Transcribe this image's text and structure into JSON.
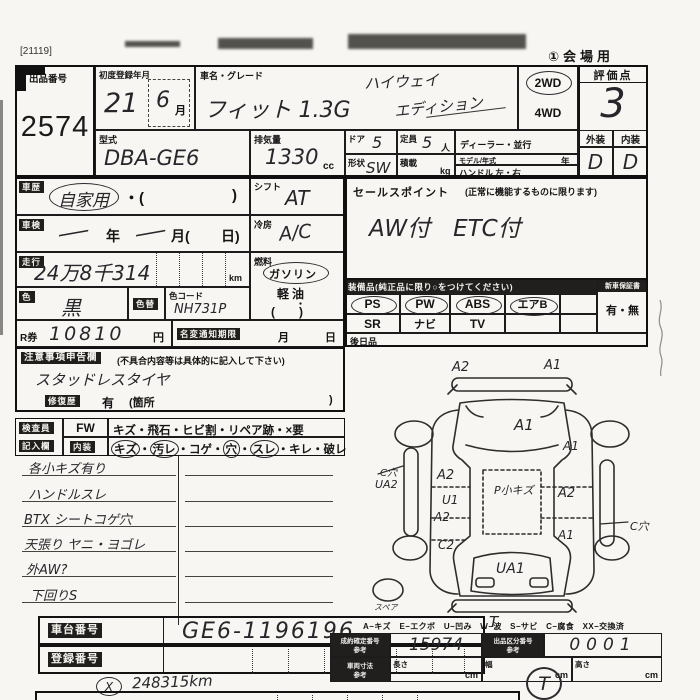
{
  "page": {
    "corner_code": "[21119]",
    "venue": "①会場用"
  },
  "header": {
    "auction_no_label": "出品番号",
    "auction_no": "2574",
    "first_reg_label": "初度登録年月",
    "first_reg_year": "21",
    "first_reg_month": "6",
    "month_suffix": "月",
    "car_name_label": "車名・グレード",
    "car_name": "フィット 1.3G",
    "car_name_hand1": "ハイウェイ",
    "car_name_hand2": "エディション",
    "drive_2wd": "2WD",
    "drive_4wd": "4WD",
    "score_label": "評価点",
    "score": "3",
    "exterior_label": "外装",
    "interior_label": "内装",
    "exterior_grade": "D",
    "interior_grade": "D",
    "model_code_label": "型式",
    "model_code": "DBA-GE6",
    "displacement_label": "排気量",
    "displacement": "1330",
    "displacement_unit": "cc",
    "doors_label": "ドア",
    "doors": "5",
    "capacity_label": "定員",
    "capacity": "5",
    "capacity_unit": "人",
    "dealer_label": "ディーラー・並行",
    "model_year_label": "モデル/年式",
    "year_suffix": "年",
    "shape_label": "形状",
    "shape": "SW",
    "load_label": "積載",
    "load_unit": "kg",
    "handle_label": "ハンドル 左・右"
  },
  "left": {
    "history_label": "車歴",
    "history_value": "自家用",
    "history_open": "・(",
    "history_close": ")",
    "shift_label": "シフト",
    "shift_value": "AT",
    "inspection_label": "車検",
    "insp_slash1": "一",
    "insp_year": "年",
    "insp_slash2": "一",
    "insp_month": "月(",
    "insp_day": "日)",
    "aircon_label": "冷房",
    "aircon_value": "A/C",
    "mileage_label": "走行",
    "mileage_value": "24万8千314",
    "mileage_unit": "km",
    "fuel_label": "燃料",
    "fuel_gasoline": "ガソリン",
    "fuel_diesel": "軽油",
    "fuel_dot": "・",
    "fuel_paren": "(　　)",
    "color_label": "色",
    "color_value": "黒",
    "color_change_label": "色替",
    "color_code_label": "色コード",
    "color_code": "NH731P",
    "rticket_label": "R券",
    "rticket_value": "10810",
    "yen": "円",
    "namechange_label": "名変通知期限",
    "month": "月",
    "day": "日"
  },
  "sales": {
    "label": "セールスポイント",
    "note": "(正常に機能するものに限ります)",
    "value": "AW付　ETC付"
  },
  "equipment": {
    "label": "装備品(純正品に限り○をつけてください)",
    "row1": [
      "PS",
      "PW",
      "ABS",
      "エアB"
    ],
    "row2": [
      "SR",
      "ナビ",
      "TV"
    ],
    "warranty_label": "新車保証書",
    "warranty_value": "有・無",
    "later_label": "後日品"
  },
  "notice": {
    "label": "注意事項申告欄",
    "note": "(不具合内容等は具体的に記入して下さい)",
    "value": "スタッドレスタイヤ",
    "repair_label": "修復歴",
    "repair_value": "有",
    "repair_open": "(箇所",
    "repair_close": ")"
  },
  "inspector": {
    "rowhead1": "検査員",
    "rowhead2": "記入欄",
    "fw_label": "FW",
    "fw_items": "キズ・飛石・ヒビ割・リペア跡・×要",
    "int_label": "内装",
    "sep": "・",
    "int_items": [
      "キズ",
      "汚レ",
      "コゲ",
      "穴",
      "スレ",
      "キレ",
      "破レ"
    ]
  },
  "notes": {
    "lines": [
      "各小キズ有り",
      "ハンドルスレ",
      "BTX シートコゲ穴",
      "天張り ヤニ・ヨゴレ",
      "外AW?",
      "下回りS"
    ]
  },
  "diagram": {
    "legend": "A−キズ　E−エクボ　U−凹み　W−波　S−サビ　C−腐食　XX−交換済",
    "labels": {
      "front_left": "A2",
      "front_right": "A1",
      "hood": "A1",
      "right_fender": "A1",
      "left_hole": "C穴",
      "left_rocker": "UA2",
      "left_door1": "A2",
      "left_door_u": "U1",
      "left_door2": "A2",
      "left_quarter": "C2",
      "roof": "P小キズ",
      "right_door": "A2",
      "right_quarter": "A1",
      "right_hole": "C穴",
      "tailgate": "UA1",
      "spare": "スペア"
    }
  },
  "footer": {
    "chassis_label": "車台番号",
    "chassis_value": "GE6-1196196",
    "reg_label": "登録番号",
    "t_mark": "T",
    "ref1_label": "成約確定番号",
    "ref2_label": "出品区分番号",
    "dims_label": "車両寸法",
    "ref_sub": "参考",
    "ref1_value": "15974",
    "ref2_value": "0001",
    "length_label": "長さ",
    "width_label": "幅",
    "height_label": "高さ",
    "cm": "cm",
    "meter_mark": "X",
    "meter_value": "248315km",
    "t_circle": "T"
  }
}
